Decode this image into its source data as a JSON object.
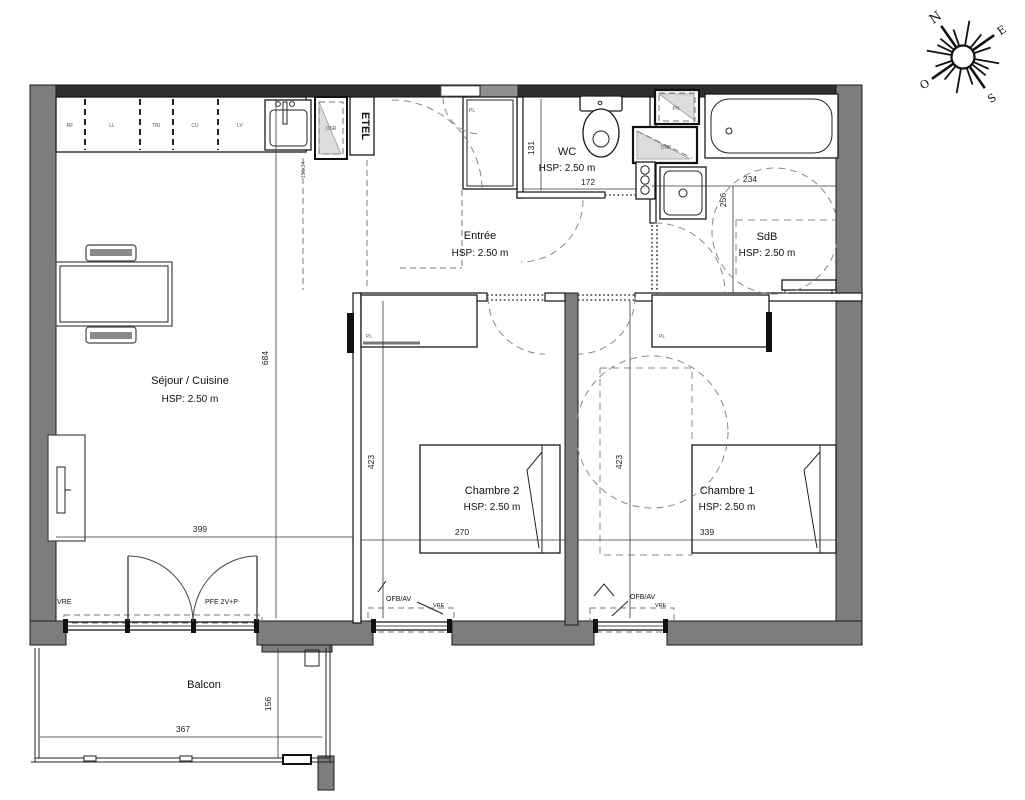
{
  "compass": {
    "north": "N",
    "east": "E",
    "south": "S",
    "west": "O"
  },
  "rooms": {
    "sejour": {
      "name": "Séjour / Cuisine",
      "hsp": "HSP: 2.50 m"
    },
    "entree": {
      "name": "Entrée",
      "hsp": "HSP: 2.50 m"
    },
    "wc": {
      "name": "WC",
      "hsp": "HSP: 2.50 m"
    },
    "sdb": {
      "name": "SdB",
      "hsp": "HSP: 2.50 m"
    },
    "chambre2": {
      "name": "Chambre 2",
      "hsp": "HSP: 2.50 m"
    },
    "chambre1": {
      "name": "Chambre 1",
      "hsp": "HSP: 2.50 m"
    },
    "balcon": {
      "name": "Balcon"
    }
  },
  "kitchen": {
    "units": [
      "RF",
      "LL",
      "TRI",
      "CU",
      "LV"
    ]
  },
  "fixtures": {
    "etel": "ETEL",
    "duct_square": "PN",
    "duct_triangle": "OSR",
    "duct_kitchen": "OSR",
    "closet_label": "PL",
    "window_note": "150x34"
  },
  "openings": {
    "vre": "VRE",
    "pfe": "PFE 2V+P",
    "ofb": "OFB/AV"
  },
  "dims": {
    "sejour_w": "399",
    "sejour_h": "684",
    "balcon_w": "367",
    "balcon_h": "156",
    "wc_w": "172",
    "wc_h": "131",
    "sdb_w": "234",
    "sdb_h": "256",
    "ch2_w": "270",
    "ch2_h": "423",
    "ch1_w": "339",
    "ch1_h": "423"
  }
}
